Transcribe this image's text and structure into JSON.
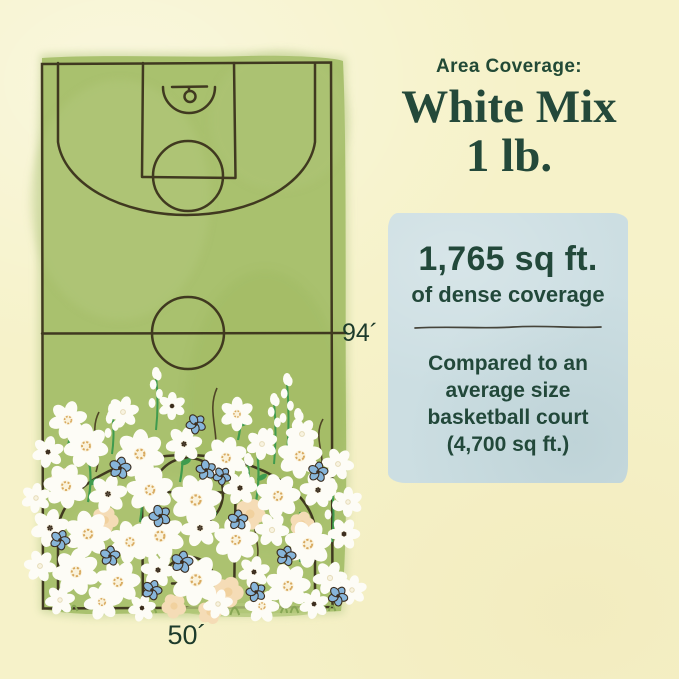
{
  "page": {
    "background": "#f6f2c9"
  },
  "header": {
    "eyebrow": "Area Coverage:",
    "title_line1": "White Mix",
    "title_line2": "1 lb.",
    "text_color": "#24493a"
  },
  "stats_card": {
    "background": "#ccdee2",
    "stat": "1,765 sq ft.",
    "stat_caption": "of dense coverage",
    "comparison_lines": [
      "Compared to an",
      "average size",
      "basketball court",
      "(4,700 sq ft.)"
    ]
  },
  "court": {
    "length_label": "94´",
    "width_label": "50´",
    "green": "#a9c16e",
    "line_color": "#3a321c",
    "label_color": "#1d3b2b"
  },
  "illustration": {
    "petal_color": "#fdfcf6",
    "blue_color": "#87b5da",
    "peach_color": "#f5dcb6",
    "stem_color": "#3f9b4e",
    "items": [
      {
        "t": "tw",
        "x": 96,
        "y": 472,
        "s": 60
      },
      {
        "t": "tw",
        "x": 214,
        "y": 458,
        "s": 70
      },
      {
        "t": "tw",
        "x": 320,
        "y": 474,
        "s": 55
      },
      {
        "t": "tw",
        "x": 256,
        "y": 562,
        "s": 50
      },
      {
        "t": "st",
        "x": 140,
        "y": 522,
        "s": 56
      },
      {
        "t": "st",
        "x": 206,
        "y": 542,
        "s": 60
      },
      {
        "t": "st",
        "x": 256,
        "y": 502,
        "s": 55
      },
      {
        "t": "st",
        "x": 88,
        "y": 502,
        "s": 45
      },
      {
        "t": "st",
        "x": 300,
        "y": 562,
        "s": 50
      },
      {
        "t": "st",
        "x": 180,
        "y": 482,
        "s": 45
      },
      {
        "t": "st",
        "x": 68,
        "y": 446,
        "s": 40
      },
      {
        "t": "st",
        "x": 238,
        "y": 440,
        "s": 38
      },
      {
        "t": "sp",
        "x": 156,
        "y": 430,
        "s": 54
      },
      {
        "t": "sp",
        "x": 287,
        "y": 454,
        "s": 72
      },
      {
        "t": "sp",
        "x": 274,
        "y": 464,
        "s": 62
      },
      {
        "t": "sp",
        "x": 298,
        "y": 472,
        "s": 55
      },
      {
        "t": "sp",
        "x": 112,
        "y": 454,
        "s": 42
      },
      {
        "t": "sp",
        "x": 248,
        "y": 522,
        "s": 60
      },
      {
        "t": "sp",
        "x": 332,
        "y": 542,
        "s": 55
      },
      {
        "t": "tf",
        "x": 150,
        "y": 613,
        "s": 14
      },
      {
        "t": "tf",
        "x": 232,
        "y": 615,
        "s": 16
      },
      {
        "t": "tf",
        "x": 292,
        "y": 613,
        "s": 14
      },
      {
        "t": "tf",
        "x": 72,
        "y": 611,
        "s": 12
      },
      {
        "t": "tf",
        "x": 330,
        "y": 611,
        "s": 12
      },
      {
        "t": "p",
        "x": 105,
        "y": 520,
        "s": 13
      },
      {
        "t": "p",
        "x": 62,
        "y": 478,
        "s": 11
      },
      {
        "t": "p",
        "x": 250,
        "y": 514,
        "s": 15
      },
      {
        "t": "p",
        "x": 302,
        "y": 524,
        "s": 12
      },
      {
        "t": "p",
        "x": 228,
        "y": 592,
        "s": 15
      },
      {
        "t": "p",
        "x": 174,
        "y": 606,
        "s": 12
      },
      {
        "t": "p",
        "x": 210,
        "y": 612,
        "s": 12
      },
      {
        "t": "w1",
        "x": 68,
        "y": 420,
        "s": 18
      },
      {
        "t": "w3",
        "x": 123,
        "y": 412,
        "s": 15
      },
      {
        "t": "w2",
        "x": 172,
        "y": 406,
        "s": 13
      },
      {
        "t": "w1",
        "x": 237,
        "y": 414,
        "s": 16
      },
      {
        "t": "w3",
        "x": 302,
        "y": 434,
        "s": 15
      },
      {
        "t": "w2",
        "x": 48,
        "y": 452,
        "s": 15
      },
      {
        "t": "w1",
        "x": 86,
        "y": 446,
        "s": 21
      },
      {
        "t": "w1",
        "x": 140,
        "y": 454,
        "s": 23
      },
      {
        "t": "w2",
        "x": 184,
        "y": 444,
        "s": 17
      },
      {
        "t": "w1",
        "x": 226,
        "y": 458,
        "s": 20
      },
      {
        "t": "w3",
        "x": 262,
        "y": 444,
        "s": 15
      },
      {
        "t": "w1",
        "x": 300,
        "y": 456,
        "s": 21
      },
      {
        "t": "w3",
        "x": 338,
        "y": 464,
        "s": 15
      },
      {
        "t": "w3",
        "x": 36,
        "y": 498,
        "s": 14
      },
      {
        "t": "w1",
        "x": 66,
        "y": 486,
        "s": 21
      },
      {
        "t": "w2",
        "x": 108,
        "y": 494,
        "s": 18
      },
      {
        "t": "w1",
        "x": 150,
        "y": 490,
        "s": 22
      },
      {
        "t": "w1",
        "x": 196,
        "y": 500,
        "s": 24
      },
      {
        "t": "w2",
        "x": 240,
        "y": 488,
        "s": 16
      },
      {
        "t": "w1",
        "x": 278,
        "y": 496,
        "s": 21
      },
      {
        "t": "w2",
        "x": 318,
        "y": 490,
        "s": 17
      },
      {
        "t": "w3",
        "x": 348,
        "y": 502,
        "s": 14
      },
      {
        "t": "w2",
        "x": 50,
        "y": 528,
        "s": 18
      },
      {
        "t": "w1",
        "x": 88,
        "y": 534,
        "s": 22
      },
      {
        "t": "w1",
        "x": 130,
        "y": 542,
        "s": 20
      },
      {
        "t": "w1",
        "x": 160,
        "y": 536,
        "s": 23
      },
      {
        "t": "w2",
        "x": 200,
        "y": 528,
        "s": 18
      },
      {
        "t": "w1",
        "x": 236,
        "y": 540,
        "s": 21
      },
      {
        "t": "w3",
        "x": 272,
        "y": 530,
        "s": 16
      },
      {
        "t": "w1",
        "x": 308,
        "y": 544,
        "s": 22
      },
      {
        "t": "w2",
        "x": 344,
        "y": 534,
        "s": 15
      },
      {
        "t": "w3",
        "x": 40,
        "y": 566,
        "s": 15
      },
      {
        "t": "w1",
        "x": 76,
        "y": 572,
        "s": 22
      },
      {
        "t": "w1",
        "x": 118,
        "y": 582,
        "s": 21
      },
      {
        "t": "w2",
        "x": 158,
        "y": 570,
        "s": 16
      },
      {
        "t": "w1",
        "x": 196,
        "y": 580,
        "s": 24
      },
      {
        "t": "w2",
        "x": 254,
        "y": 572,
        "s": 15
      },
      {
        "t": "w1",
        "x": 288,
        "y": 586,
        "s": 21
      },
      {
        "t": "w3",
        "x": 330,
        "y": 578,
        "s": 16
      },
      {
        "t": "w3",
        "x": 352,
        "y": 590,
        "s": 14
      },
      {
        "t": "w3",
        "x": 60,
        "y": 600,
        "s": 14
      },
      {
        "t": "w1",
        "x": 102,
        "y": 602,
        "s": 17
      },
      {
        "t": "w2",
        "x": 142,
        "y": 608,
        "s": 13
      },
      {
        "t": "w3",
        "x": 218,
        "y": 604,
        "s": 14
      },
      {
        "t": "w1",
        "x": 262,
        "y": 606,
        "s": 16
      },
      {
        "t": "w2",
        "x": 314,
        "y": 604,
        "s": 14
      },
      {
        "t": "b",
        "x": 196,
        "y": 424,
        "s": 10
      },
      {
        "t": "b",
        "x": 120,
        "y": 468,
        "s": 11
      },
      {
        "t": "b",
        "x": 206,
        "y": 470,
        "s": 10
      },
      {
        "t": "b",
        "x": 160,
        "y": 516,
        "s": 11
      },
      {
        "t": "b",
        "x": 238,
        "y": 520,
        "s": 10
      },
      {
        "t": "b",
        "x": 110,
        "y": 556,
        "s": 10
      },
      {
        "t": "b",
        "x": 182,
        "y": 562,
        "s": 11
      },
      {
        "t": "b",
        "x": 286,
        "y": 556,
        "s": 10
      },
      {
        "t": "b",
        "x": 318,
        "y": 472,
        "s": 10
      },
      {
        "t": "b",
        "x": 338,
        "y": 596,
        "s": 10
      },
      {
        "t": "b",
        "x": 152,
        "y": 590,
        "s": 10
      },
      {
        "t": "b",
        "x": 256,
        "y": 592,
        "s": 10
      },
      {
        "t": "b",
        "x": 60,
        "y": 540,
        "s": 10
      },
      {
        "t": "b",
        "x": 222,
        "y": 476,
        "s": 9
      }
    ]
  }
}
